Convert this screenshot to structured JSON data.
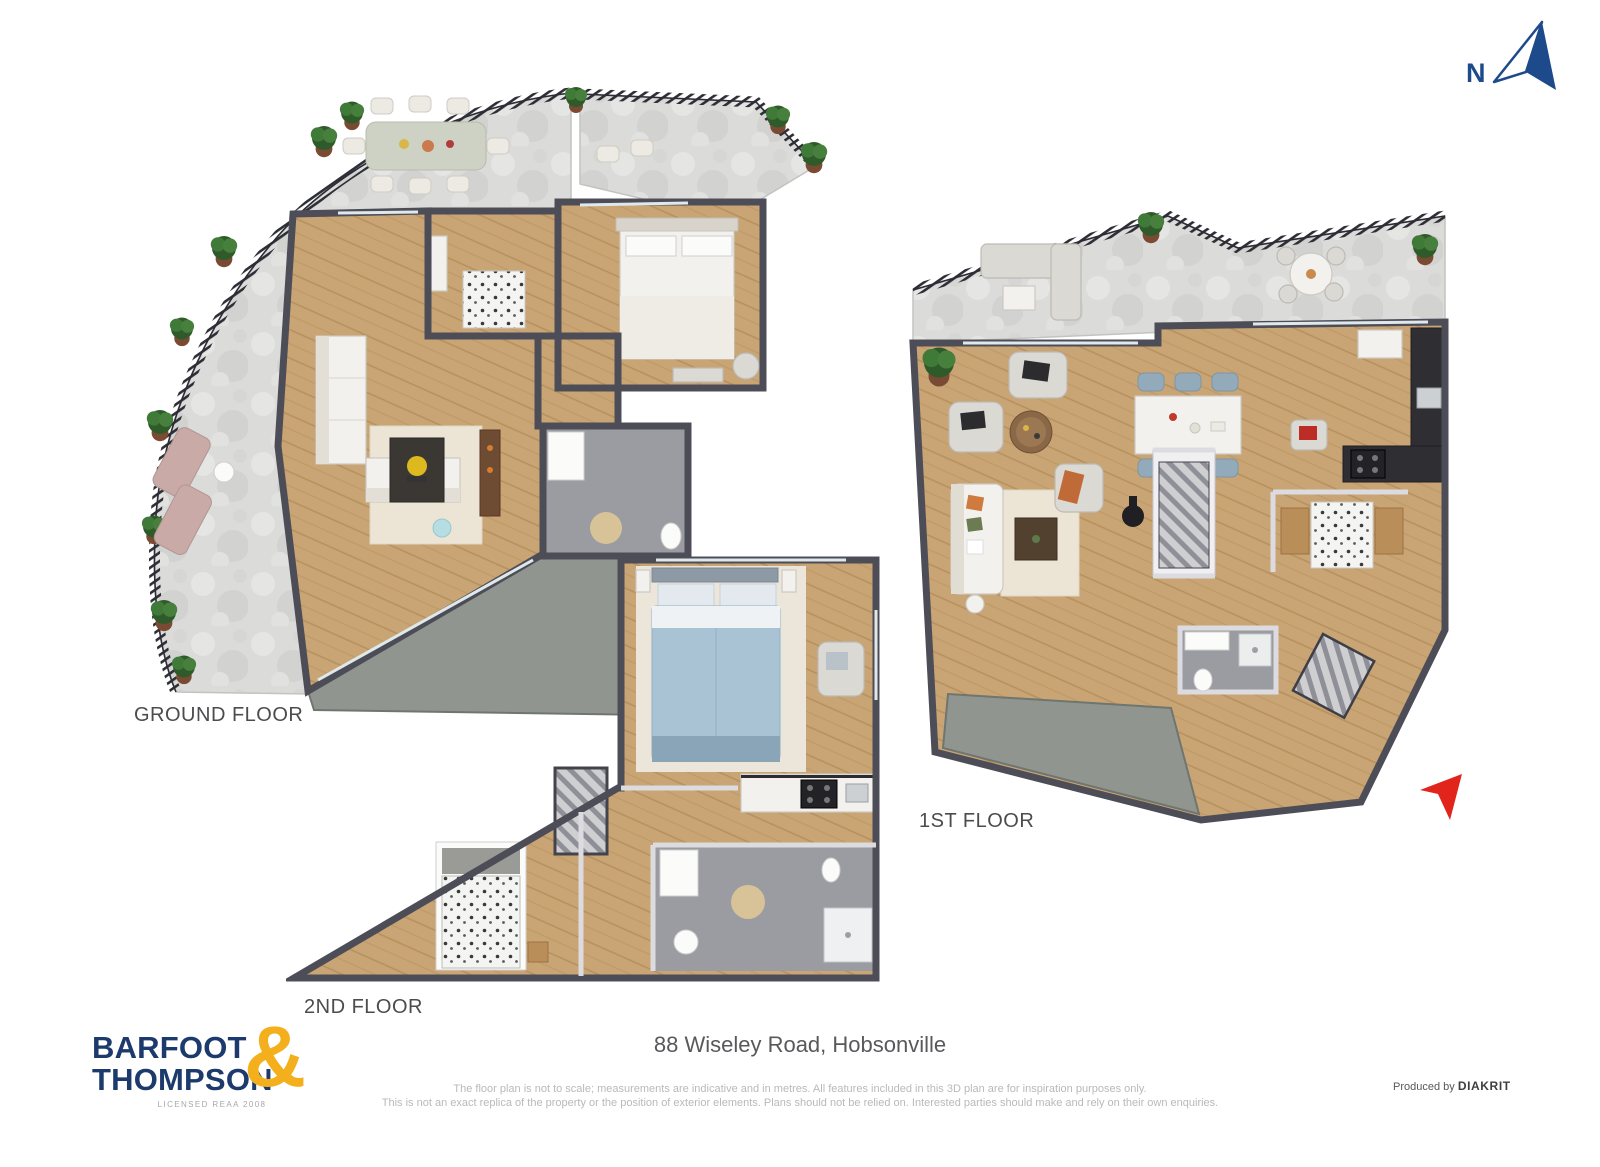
{
  "compass": {
    "label": "N"
  },
  "plans": [
    {
      "id": "ground",
      "label": "GROUND FLOOR"
    },
    {
      "id": "first",
      "label": "1ST FLOOR"
    },
    {
      "id": "second",
      "label": "2ND FLOOR"
    }
  ],
  "footer": {
    "address": "88 Wiseley Road, Hobsonville",
    "disclaimer_line1": "The floor plan is not to scale; measurements are indicative and in metres. All features included in this 3D plan are for inspiration purposes only.",
    "disclaimer_line2": "This is not an exact replica of the property or the position of exterior elements. Plans should not be relied on. Interested parties should make and rely on their own enquiries.",
    "produced_by": "Produced by",
    "producer": "DIAKRIT"
  },
  "logo": {
    "line1": "BARFOOT",
    "line2": "THOMPSON",
    "ampersand": "&",
    "tagline": "LICENSED REAA 2008"
  },
  "colors": {
    "navy": "#1d3a6d",
    "gold": "#f3b01c",
    "marker": "#e2251c",
    "compass": "#1d4a8a",
    "wall": "#4d4d58",
    "wood": "#c9a474",
    "terrace": "#dbdbda",
    "bath_floor": "#9b9ba2",
    "walkway": "#90968f",
    "label_text": "#4c4c4e",
    "muted_text": "#b9b9bb"
  }
}
